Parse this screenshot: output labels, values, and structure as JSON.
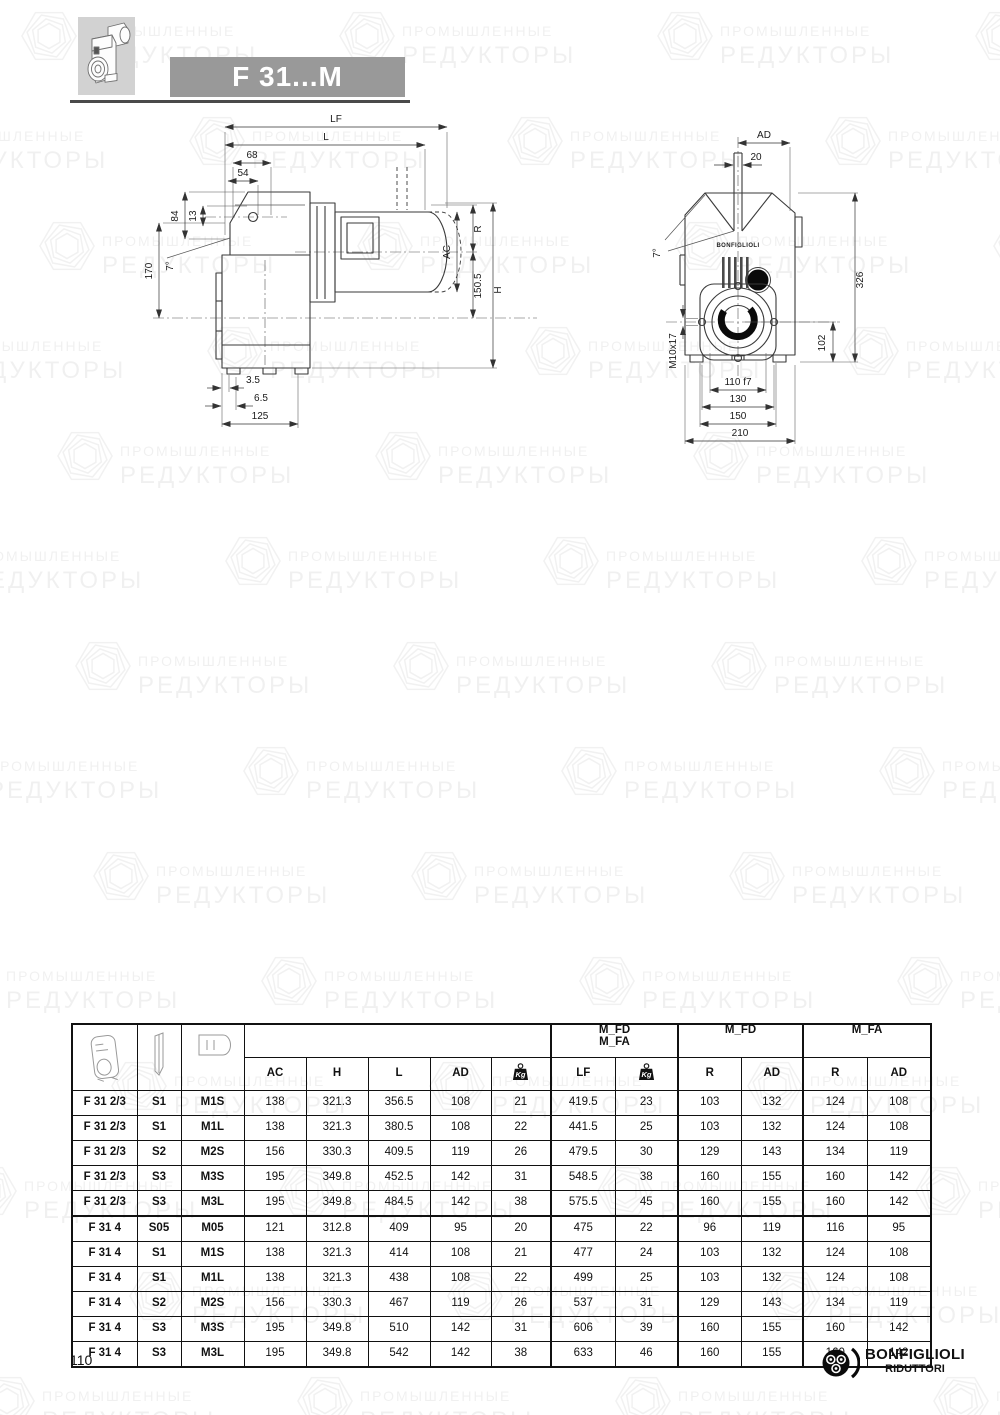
{
  "banner": {
    "title": "F 31...M"
  },
  "watermark": {
    "line1": "ПРОМЫШЛЕННЫЕ",
    "line2": "РЕДУКТОРЫ"
  },
  "drawings": {
    "side_view": {
      "labels": {
        "lf": "LF",
        "l": "L",
        "d68": "68",
        "d54": "54",
        "d13": "13",
        "d84": "84",
        "d170": "170",
        "angle": "7°",
        "r": "R",
        "ac": "AC",
        "d150_5": "150.5",
        "h": "H",
        "d3_5": "3.5",
        "d6_5": "6.5",
        "d125": "125"
      }
    },
    "front_view": {
      "brand": "BONFIGLIOLI",
      "labels": {
        "ad": "AD",
        "d20": "20",
        "angle": "7°",
        "d326": "326",
        "d102": "102",
        "m10": "M10x17",
        "d110": "110 f7",
        "d130": "130",
        "d150": "150",
        "d210": "210"
      }
    }
  },
  "table": {
    "group_headers": {
      "combo_line1": "M_FD",
      "combo_line2": "M_FA",
      "fd": "M_FD",
      "fa": "M_FA"
    },
    "columns": {
      "ac": "AC",
      "h": "H",
      "l": "L",
      "ad": "AD",
      "kg_icon": "Kg",
      "lf": "LF",
      "kg2_icon": "Kg",
      "r_fd": "R",
      "ad_fd": "AD",
      "r_fa": "R",
      "ad_fa": "AD"
    },
    "rows": [
      {
        "model": "F 31 2/3",
        "s": "S1",
        "m": "M1S",
        "ac": "138",
        "h": "321.3",
        "l": "356.5",
        "ad": "108",
        "kg": "21",
        "lf": "419.5",
        "kg2": "23",
        "r_fd": "103",
        "ad_fd": "132",
        "r_fa": "124",
        "ad_fa": "108"
      },
      {
        "model": "F 31 2/3",
        "s": "S1",
        "m": "M1L",
        "ac": "138",
        "h": "321.3",
        "l": "380.5",
        "ad": "108",
        "kg": "22",
        "lf": "441.5",
        "kg2": "25",
        "r_fd": "103",
        "ad_fd": "132",
        "r_fa": "124",
        "ad_fa": "108"
      },
      {
        "model": "F 31 2/3",
        "s": "S2",
        "m": "M2S",
        "ac": "156",
        "h": "330.3",
        "l": "409.5",
        "ad": "119",
        "kg": "26",
        "lf": "479.5",
        "kg2": "30",
        "r_fd": "129",
        "ad_fd": "143",
        "r_fa": "134",
        "ad_fa": "119"
      },
      {
        "model": "F 31 2/3",
        "s": "S3",
        "m": "M3S",
        "ac": "195",
        "h": "349.8",
        "l": "452.5",
        "ad": "142",
        "kg": "31",
        "lf": "548.5",
        "kg2": "38",
        "r_fd": "160",
        "ad_fd": "155",
        "r_fa": "160",
        "ad_fa": "142"
      },
      {
        "model": "F 31 2/3",
        "s": "S3",
        "m": "M3L",
        "ac": "195",
        "h": "349.8",
        "l": "484.5",
        "ad": "142",
        "kg": "38",
        "lf": "575.5",
        "kg2": "45",
        "r_fd": "160",
        "ad_fd": "155",
        "r_fa": "160",
        "ad_fa": "142"
      },
      {
        "model": "F 31 4",
        "s": "S05",
        "m": "M05",
        "ac": "121",
        "h": "312.8",
        "l": "409",
        "ad": "95",
        "kg": "20",
        "lf": "475",
        "kg2": "22",
        "r_fd": "96",
        "ad_fd": "119",
        "r_fa": "116",
        "ad_fa": "95"
      },
      {
        "model": "F 31 4",
        "s": "S1",
        "m": "M1S",
        "ac": "138",
        "h": "321.3",
        "l": "414",
        "ad": "108",
        "kg": "21",
        "lf": "477",
        "kg2": "24",
        "r_fd": "103",
        "ad_fd": "132",
        "r_fa": "124",
        "ad_fa": "108"
      },
      {
        "model": "F 31 4",
        "s": "S1",
        "m": "M1L",
        "ac": "138",
        "h": "321.3",
        "l": "438",
        "ad": "108",
        "kg": "22",
        "lf": "499",
        "kg2": "25",
        "r_fd": "103",
        "ad_fd": "132",
        "r_fa": "124",
        "ad_fa": "108"
      },
      {
        "model": "F 31 4",
        "s": "S2",
        "m": "M2S",
        "ac": "156",
        "h": "330.3",
        "l": "467",
        "ad": "119",
        "kg": "26",
        "lf": "537",
        "kg2": "31",
        "r_fd": "129",
        "ad_fd": "143",
        "r_fa": "134",
        "ad_fa": "119"
      },
      {
        "model": "F 31 4",
        "s": "S3",
        "m": "M3S",
        "ac": "195",
        "h": "349.8",
        "l": "510",
        "ad": "142",
        "kg": "31",
        "lf": "606",
        "kg2": "39",
        "r_fd": "160",
        "ad_fd": "155",
        "r_fa": "160",
        "ad_fa": "142"
      },
      {
        "model": "F 31 4",
        "s": "S3",
        "m": "M3L",
        "ac": "195",
        "h": "349.8",
        "l": "542",
        "ad": "142",
        "kg": "38",
        "lf": "633",
        "kg2": "46",
        "r_fd": "160",
        "ad_fd": "155",
        "r_fa": "160",
        "ad_fa": "142"
      }
    ]
  },
  "footer": {
    "page_number": "110",
    "logo_line1": "BONFIGLIOLI",
    "logo_line2": "RIDUTTORI"
  }
}
